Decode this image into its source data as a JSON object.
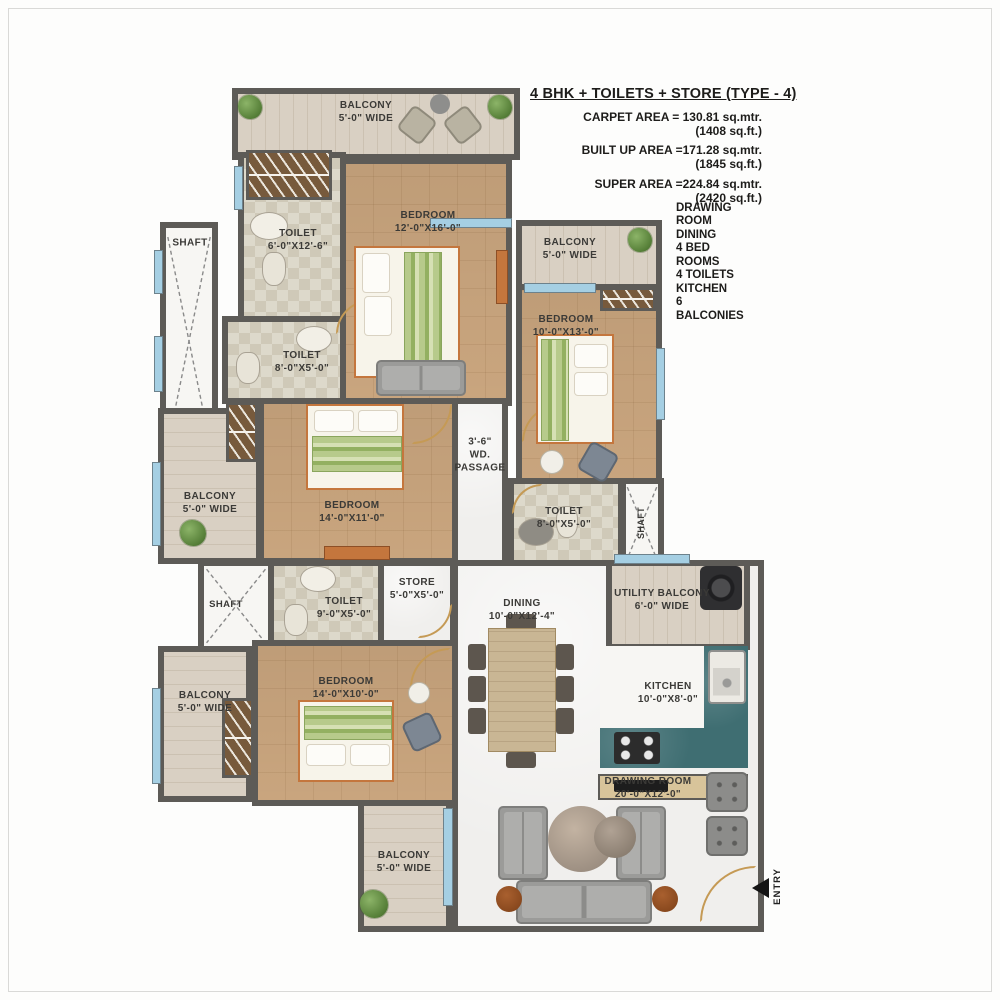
{
  "header": {
    "title": "4 BHK + TOILETS + STORE (TYPE - 4)",
    "areas": [
      {
        "line1": "CARPET AREA = 130.81 sq.mtr.",
        "line2": "(1408 sq.ft.)"
      },
      {
        "line1": "BUILT UP AREA =171.28 sq.mtr.",
        "line2": "(1845 sq.ft.)"
      },
      {
        "line1": "SUPER AREA =224.84 sq.mtr.",
        "line2": "(2420 sq.ft.)"
      }
    ],
    "features": [
      "DRAWING ROOM",
      "DINING",
      "4 BED ROOMS",
      "4 TOILETS",
      "KITCHEN",
      "6 BALCONIES"
    ]
  },
  "rooms": {
    "balcony_top": {
      "name": "BALCONY",
      "dims": "5'-0\" WIDE"
    },
    "toilet_master": {
      "name": "TOILET",
      "dims": "6'-0\"X12'-6\""
    },
    "bedroom_master": {
      "name": "BEDROOM",
      "dims": "12'-0\"X16'-0\""
    },
    "shaft_top_left": {
      "name": "SHAFT"
    },
    "toilet_2": {
      "name": "TOILET",
      "dims": "8'-0\"X5'-0\""
    },
    "balcony_right": {
      "name": "BALCONY",
      "dims": "5'-0\" WIDE"
    },
    "bedroom_2": {
      "name": "BEDROOM",
      "dims": "10'-0\"X13'-0\""
    },
    "passage": {
      "line1": "3'-6\"",
      "line2": "WD.",
      "line3": "PASSAGE"
    },
    "balcony_mid_left": {
      "name": "BALCONY",
      "dims": "5'-0\" WIDE"
    },
    "bedroom_3": {
      "name": "BEDROOM",
      "dims": "14'-0\"X11'-0\""
    },
    "toilet_3": {
      "name": "TOILET",
      "dims": "8'-0\"X5'-0\""
    },
    "shaft_right": {
      "name": "SHAFT"
    },
    "shaft_mid_left": {
      "name": "SHAFT"
    },
    "toilet_4": {
      "name": "TOILET",
      "dims": "9'-0\"X5'-0\""
    },
    "store": {
      "name": "STORE",
      "dims": "5'-0\"X5'-0\""
    },
    "utility_balcony": {
      "name": "UTILITY BALCONY",
      "dims": "6'-0\" WIDE"
    },
    "dining": {
      "name": "DINING",
      "dims": "10'-0\"X12'-4\""
    },
    "kitchen": {
      "name": "KITCHEN",
      "dims": "10'-0\"X8'-0\""
    },
    "balcony_bottom_left": {
      "name": "BALCONY",
      "dims": "5'-0\" WIDE"
    },
    "bedroom_4": {
      "name": "BEDROOM",
      "dims": "14'-0\"X10'-0\""
    },
    "drawing_room": {
      "name": "DRAWING ROOM",
      "dims": "20'-0\"X12'-0\""
    },
    "balcony_bottom": {
      "name": "BALCONY",
      "dims": "5'-0\" WIDE"
    },
    "entry": {
      "label": "ENTRY"
    }
  },
  "colors": {
    "wall": "#5d5b57",
    "bedroom_floor": "#c9a57e",
    "balcony_floor": "#d9d0c3",
    "toilet_floor": "#ddd9cb",
    "marble_floor": "#f0efed",
    "window_blue": "#a5cfe3",
    "counter_teal": "#3f6e72",
    "accent_orange": "#c4763d",
    "door_tan": "#c59a55",
    "hatch_brown": "#775a3c",
    "furniture_gray": "#9b9b99",
    "text_dark": "#2e2d2b"
  }
}
